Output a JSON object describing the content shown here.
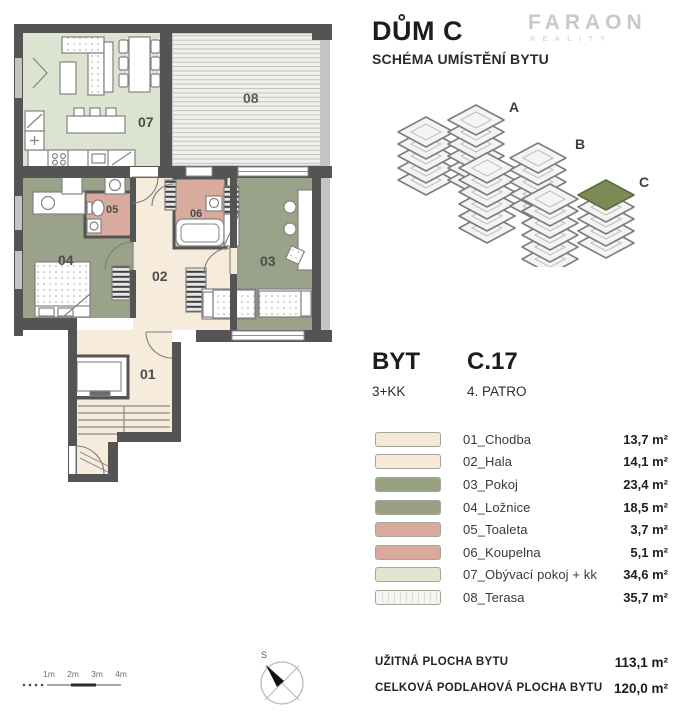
{
  "header": {
    "title": "DŮM C",
    "subtitle": "SCHÉMA UMÍSTĚNÍ BYTU"
  },
  "logo": {
    "name": "FARAON",
    "sub": "REALITY"
  },
  "location_diagram": {
    "labels": [
      "A",
      "B",
      "C"
    ]
  },
  "unit": {
    "label": "BYT",
    "code": "C.17",
    "layout": "3+KK",
    "floor": "4. PATRO"
  },
  "legend": {
    "rows": [
      {
        "id": "01",
        "label": "01_Chodba",
        "area": "13,7 m²",
        "color": "#f6e9d8"
      },
      {
        "id": "02",
        "label": "02_Hala",
        "area": "14,1 m²",
        "color": "#f6e9d8"
      },
      {
        "id": "03",
        "label": "03_Pokoj",
        "area": "23,4 m²",
        "color": "#99a185"
      },
      {
        "id": "04",
        "label": "04_Ložnice",
        "area": "18,5 m²",
        "color": "#99a185"
      },
      {
        "id": "05",
        "label": "05_Toaleta",
        "area": "3,7 m²",
        "color": "#d9a99c"
      },
      {
        "id": "06",
        "label": "06_Koupelna",
        "area": "5,1 m²",
        "color": "#d9a99c"
      },
      {
        "id": "07",
        "label": "07_Obývací pokoj + kk",
        "area": "34,6 m²",
        "color": "#dfe5d0"
      },
      {
        "id": "08",
        "label": "08_Terasa",
        "area": "35,7 m²",
        "color": "#f4f4f1"
      }
    ]
  },
  "totals": [
    {
      "label": "UŽITNÁ PLOCHA BYTU",
      "value": "113,1 m²"
    },
    {
      "label": "CELKOVÁ PODLAHOVÁ PLOCHA BYTU",
      "value": "120,0 m²"
    }
  ],
  "scalebar": {
    "ticks": [
      "1m",
      "2m",
      "3m",
      "4m"
    ]
  },
  "compass": {
    "north_label": "S"
  },
  "plan": {
    "labels": {
      "r01": "01",
      "r02": "02",
      "r03": "03",
      "r04": "04",
      "r05": "05",
      "r06": "06",
      "r07": "07",
      "r08": "08"
    }
  },
  "colors": {
    "living": "#dce3d0",
    "sage": "#9aa389",
    "pink": "#d9ab9e",
    "cream": "#f7ecdb",
    "terrace": "#f0f0ed",
    "wall": "#545454",
    "wall_light": "#c4c4c4",
    "accent": "#7c8a55"
  }
}
